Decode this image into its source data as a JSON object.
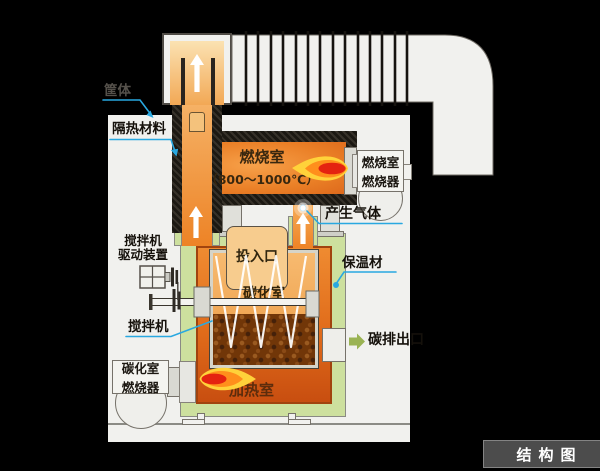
{
  "colors": {
    "background": "#000000",
    "panel": "#f1f1ee",
    "insulation_green": "#cde09e",
    "heating_orange": "#e8761f",
    "combustion_orange": "#ef9340",
    "carbon_brown": "#713608",
    "flame_yellow": "#ffd23a",
    "flame_orange": "#ff8f1c",
    "flame_red": "#e42310",
    "leader_cyan": "#29a8e0",
    "outlet_arrow_green": "#9ab353",
    "badge_bg": "#4c4c4c",
    "hatch_dark": "#221e18"
  },
  "labels": {
    "casing": "筐体",
    "heat_insulation": "隔热材料",
    "combustion_chamber": "燃烧室",
    "combustion_temp": "（800～1000℃）",
    "combustion_burner_line1": "燃烧室",
    "combustion_burner_line2": "燃烧器",
    "generated_gas": "产生气体",
    "mixer_drive_line1": "搅拌机",
    "mixer_drive_line2": "驱动装置",
    "feed_inlet": "投入口",
    "insulation_mat": "保温材",
    "carbonization_chamber": "碳化室",
    "mixer": "搅拌机",
    "carbon_outlet": "碳排出口",
    "carbonization_burner_line1": "碳化室",
    "carbonization_burner_line2": "燃烧器",
    "heating_chamber": "加热室"
  },
  "badge": {
    "title": "结构图"
  }
}
